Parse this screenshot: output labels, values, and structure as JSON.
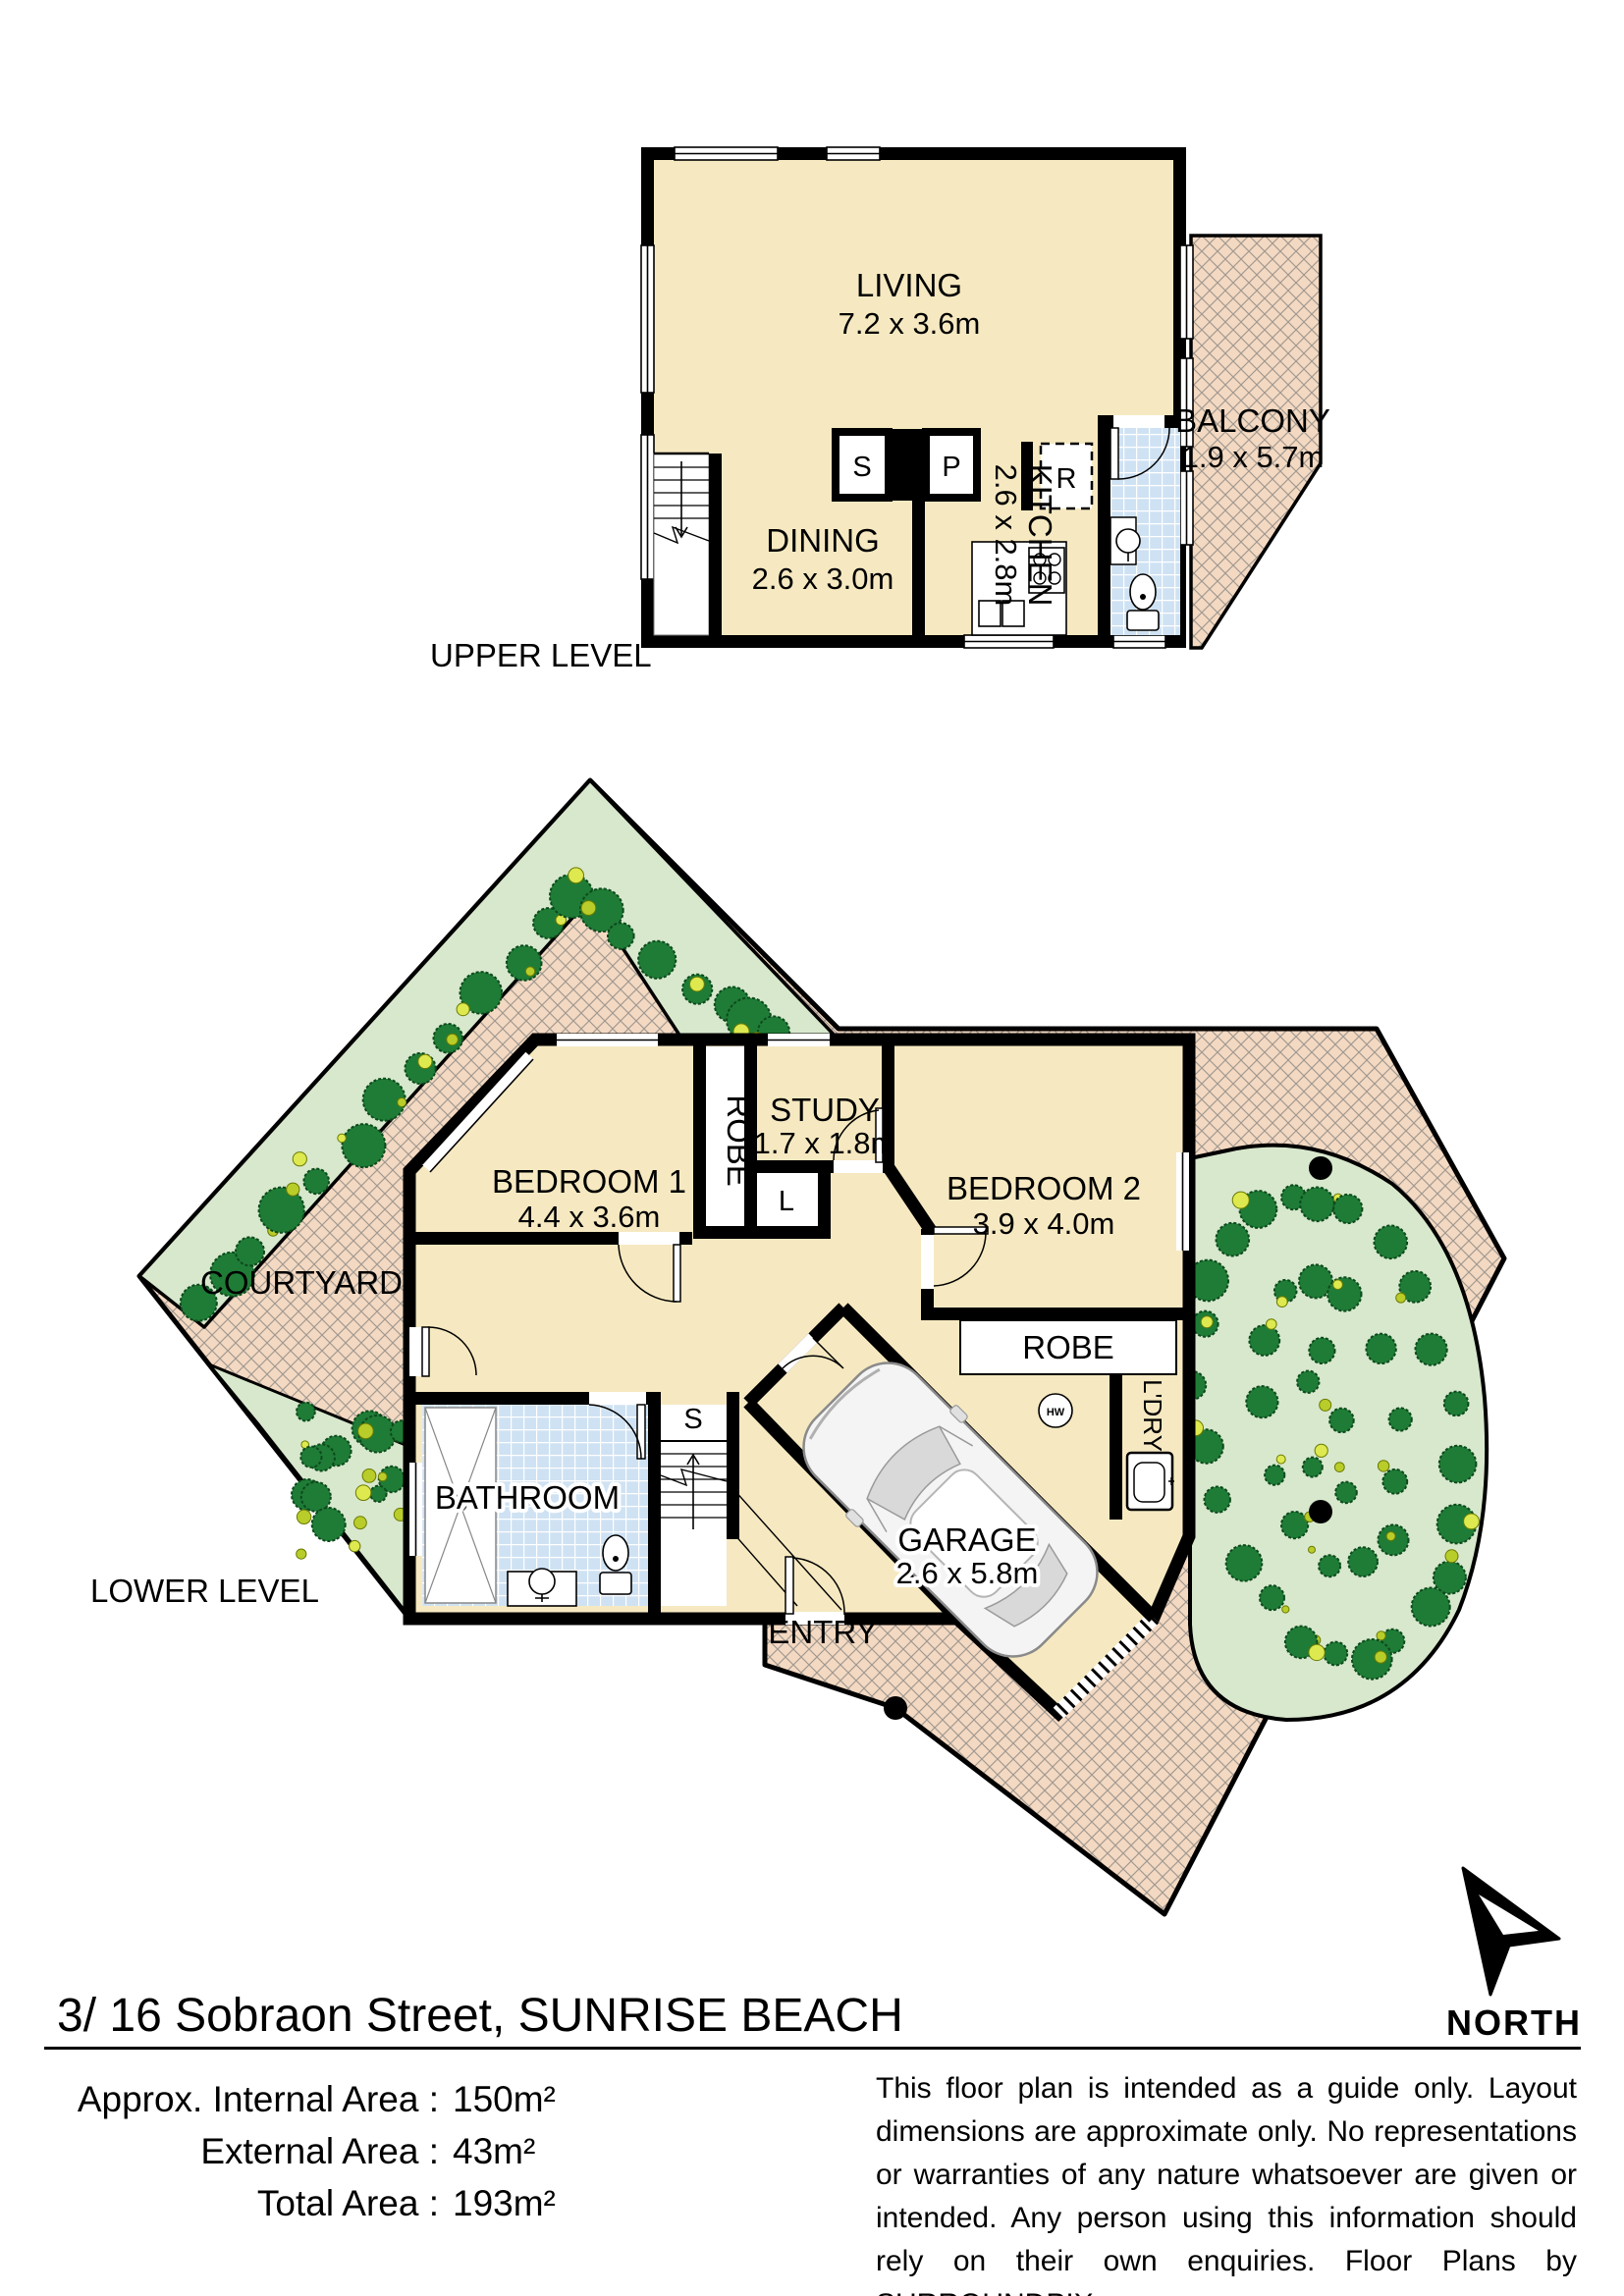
{
  "colors": {
    "room_fill": "#f6e9c1",
    "paving_fill": "#f4d9c2",
    "paving_line": "#a09890",
    "garden_fill": "#d8e8cd",
    "tile_fill": "#cfe2f3",
    "tree_dark": "#1f7c36",
    "tree_light": "#b9cd2a",
    "wall": "#000000"
  },
  "upper_level": {
    "level_label": "UPPER LEVEL",
    "rooms": {
      "living": {
        "name": "LIVING",
        "dims": "7.2 x 3.6m"
      },
      "dining": {
        "name": "DINING",
        "dims": "2.6 x 3.0m"
      },
      "kitchen": {
        "name": "KITCHEN",
        "dims": "2.6 x 2.8m"
      },
      "balcony": {
        "name": "BALCONY",
        "dims": "1.9 x 5.7m"
      }
    },
    "markers": {
      "store": "S",
      "pantry": "P",
      "fridge": "R"
    }
  },
  "lower_level": {
    "level_label": "LOWER LEVEL",
    "rooms": {
      "bedroom1": {
        "name": "BEDROOM 1",
        "dims": "4.4 x 3.6m"
      },
      "bedroom2": {
        "name": "BEDROOM 2",
        "dims": "3.9 x 4.0m"
      },
      "study": {
        "name": "STUDY",
        "dims": "1.7 x 1.8m"
      },
      "garage": {
        "name": "GARAGE",
        "dims": "2.6 x 5.8m"
      },
      "bathroom": {
        "name": "BATHROOM"
      },
      "courtyard": {
        "name": "COURTYARD"
      },
      "entry": {
        "name": "ENTRY"
      },
      "robe1": {
        "name": "ROBE"
      },
      "robe2": {
        "name": "ROBE"
      },
      "laundry": {
        "name": "L'DRY"
      }
    },
    "markers": {
      "linen": "L",
      "stairs": "S",
      "hot_water": "HW"
    }
  },
  "north": {
    "label": "NORTH"
  },
  "footer": {
    "address": "3/ 16 Sobraon Street, SUNRISE BEACH",
    "areas": [
      {
        "label": "Approx. Internal Area :",
        "value": "150m²"
      },
      {
        "label": "External Area :",
        "value": "43m²"
      },
      {
        "label": "Total Area :",
        "value": "193m²"
      }
    ],
    "disclaimer": "This floor plan is intended as a guide only. Layout dimensions are approximate only. No representations or warranties of any nature whatsoever are given or intended. Any person using this information should rely on their own enquiries. Floor Plans by  SURROUNDPIX."
  }
}
